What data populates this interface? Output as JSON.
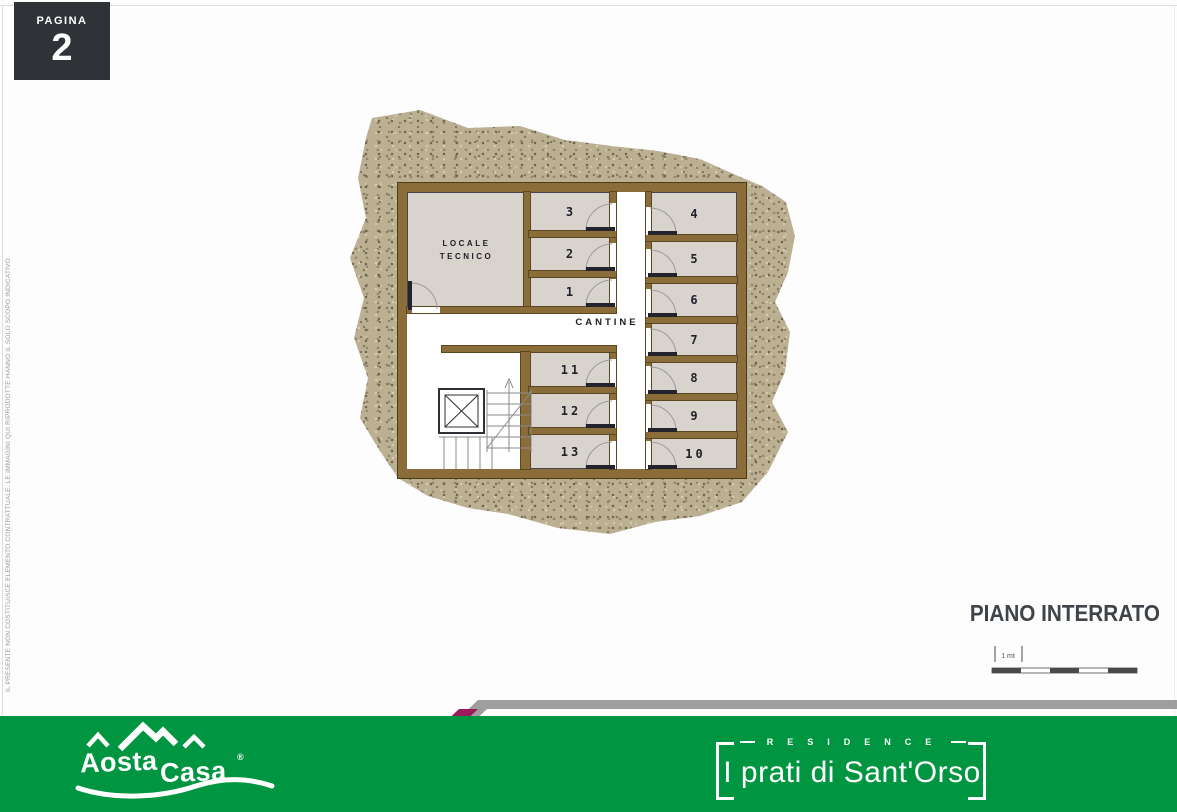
{
  "page": {
    "pagina_label": "PAGINA",
    "page_number": "2",
    "disclaimer": "IL PRESENTE NON COSTITUISCE ELEMENTO CONTRATTUALE. LE IMMAGINI QUI RIPRODOTTE HANNO IL SOLO SCOPO INDICATIVO",
    "floor_title": "PIANO INTERRATO"
  },
  "plan": {
    "technical_room_line1": "LOCALE",
    "technical_room_line2": "TECNICO",
    "hall_label": "CANTINE",
    "rooms": [
      {
        "label": "1"
      },
      {
        "label": "2"
      },
      {
        "label": "3"
      },
      {
        "label": "4"
      },
      {
        "label": "5"
      },
      {
        "label": "6"
      },
      {
        "label": "7"
      },
      {
        "label": "8"
      },
      {
        "label": "9"
      },
      {
        "label": "10"
      },
      {
        "label": "11"
      },
      {
        "label": "12"
      },
      {
        "label": "13"
      }
    ]
  },
  "scale_bar": {
    "label": "1 mt"
  },
  "footer": {
    "brand_word1": "Aosta",
    "brand_word2": "Casa",
    "brand_registered": "®",
    "residence_label": "RESIDENCE",
    "residence_name": "I prati di Sant'Orso"
  },
  "colors": {
    "green": "#009540",
    "magenta": "#9d1a58",
    "stripe_gray": "#9e9e9e",
    "wall_brown": "#8b6d39",
    "room_gray": "#d8d4cd",
    "ground_tan": "#bcb093",
    "title_gray": "#3f4449",
    "pagina_box": "#2f3237"
  }
}
